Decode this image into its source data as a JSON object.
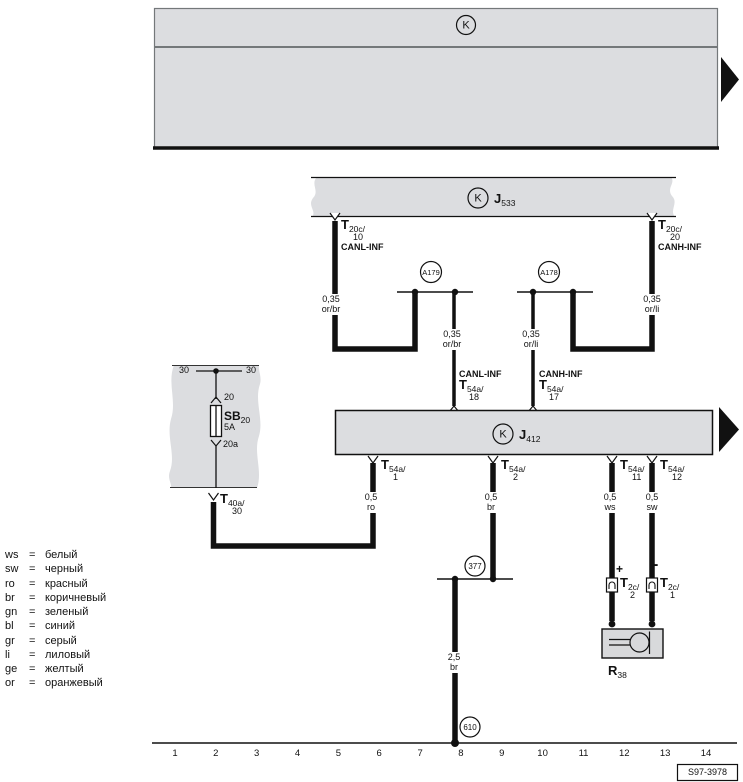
{
  "top_box": {
    "symbol": "K"
  },
  "j533": {
    "symbol": "K",
    "name": "J",
    "sub": "533"
  },
  "j412": {
    "symbol": "K",
    "name": "J",
    "sub": "412"
  },
  "a179": "A179",
  "a178": "A178",
  "j377": "377",
  "j610": "610",
  "t20c_10": {
    "t": "T",
    "sub": "20c/",
    "pin": "10",
    "bus": "CANL-INF"
  },
  "t20c_20": {
    "t": "T",
    "sub": "20c/",
    "pin": "20",
    "bus": "CANH-INF"
  },
  "t54a_18": {
    "bus": "CANL-INF",
    "t": "T",
    "sub": "54a/",
    "pin": "18"
  },
  "t54a_17": {
    "bus": "CANH-INF",
    "t": "T",
    "sub": "54a/",
    "pin": "17"
  },
  "t54a_1": {
    "t": "T",
    "sub": "54a/",
    "pin": "1"
  },
  "t54a_2": {
    "t": "T",
    "sub": "54a/",
    "pin": "2"
  },
  "t54a_11": {
    "t": "T",
    "sub": "54a/",
    "pin": "11"
  },
  "t54a_12": {
    "t": "T",
    "sub": "54a/",
    "pin": "12"
  },
  "t40a_30": {
    "t": "T",
    "sub": "40a/",
    "pin": "30"
  },
  "t2c_2": {
    "t": "T",
    "sub": "2c/",
    "pin": "2",
    "polarity": "+"
  },
  "t2c_1": {
    "t": "T",
    "sub": "2c/",
    "pin": "1",
    "polarity": "-"
  },
  "w_canl_stub": {
    "size": "0,35",
    "color": "or/br"
  },
  "w_canl_drop": {
    "size": "0,35",
    "color": "or/br"
  },
  "w_canh_stub": {
    "size": "0,35",
    "color": "or/li"
  },
  "w_canh_drop": {
    "size": "0,35",
    "color": "or/li"
  },
  "w_ro": {
    "size": "0,5",
    "color": "ro"
  },
  "w_br": {
    "size": "0,5",
    "color": "br"
  },
  "w_ws": {
    "size": "0,5",
    "color": "ws"
  },
  "w_sw": {
    "size": "0,5",
    "color": "sw"
  },
  "w_gnd": {
    "size": "2,5",
    "color": "br"
  },
  "fuse": {
    "term30_l": "30",
    "term30_r": "30",
    "in_pin": "20",
    "name": "SB",
    "sub": "20",
    "rating": "5A",
    "out_pin": "20a"
  },
  "r38": {
    "name": "R",
    "sub": "38"
  },
  "legend_eq": "=",
  "legend": [
    {
      "code": "ws",
      "name": "белый"
    },
    {
      "code": "sw",
      "name": "черный"
    },
    {
      "code": "ro",
      "name": "красный"
    },
    {
      "code": "br",
      "name": "коричневый"
    },
    {
      "code": "gn",
      "name": "зеленый"
    },
    {
      "code": "bl",
      "name": "синий"
    },
    {
      "code": "gr",
      "name": "серый"
    },
    {
      "code": "li",
      "name": "лиловый"
    },
    {
      "code": "ge",
      "name": "желтый"
    },
    {
      "code": "or",
      "name": "оранжевый"
    }
  ],
  "tracks": [
    "1",
    "2",
    "3",
    "4",
    "5",
    "6",
    "7",
    "8",
    "9",
    "10",
    "11",
    "12",
    "13",
    "14"
  ],
  "diagram_id": "S97-3978",
  "colors": {
    "box_fill": "#dcdde0",
    "line": "#111111",
    "frame": "#74787a"
  }
}
